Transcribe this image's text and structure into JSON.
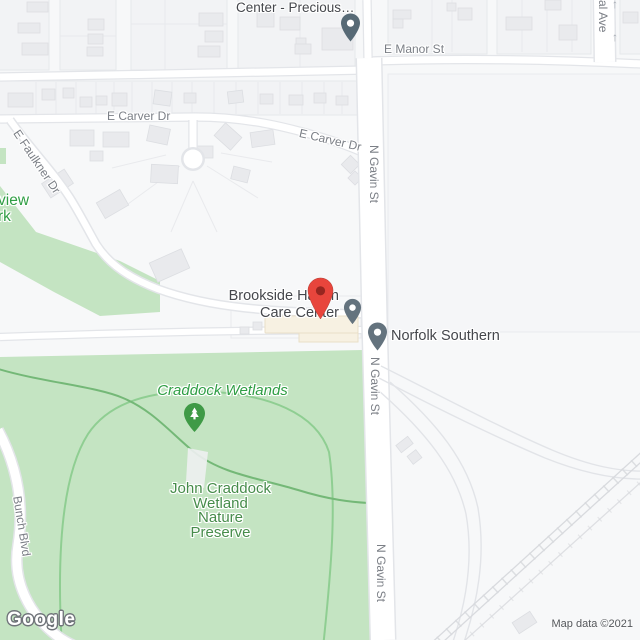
{
  "colors": {
    "land": "#f7f8f9",
    "block": "#f2f3f5",
    "block-line": "#e6e8eb",
    "building": "#e9eaed",
    "building-line": "#dcdee2",
    "road-fill": "#ffffff",
    "road-casing": "#e3e5e9",
    "park": "#c4e4c2",
    "trail": "#74b877",
    "preserve-line": "#8fce92",
    "street-label": "#7b7f86",
    "poi-label": "#45474c",
    "park-label": "#2f9e44",
    "preserve-label": "#468c4a",
    "pin-red": "#e8453c",
    "pin-red-dot": "#972620",
    "pin-gray": "#64737e",
    "pin-dark": "#576a76",
    "pin-green": "#3f9a46",
    "rail": "#d8dade",
    "ramp": "#e2e4e8",
    "poi-building": "#f7f1e2",
    "poi-building-line": "#eadfc8",
    "attr-text": "#53565a",
    "logo-outline": "#70747a",
    "oneway": "#a6abb3"
  },
  "streets": {
    "e_manor": "E Manor St",
    "e_carver_upper": "E Carver Dr",
    "e_carver_lower": "E Carver Dr",
    "e_faulkner": "E Faulkner Dr",
    "n_gavin_upper": "N Gavin St",
    "n_gavin_middle": "N Gavin St",
    "n_gavin_lower": "N Gavin St",
    "al_ave": "al Ave",
    "bunch_blvd": "Bunch Blvd"
  },
  "places": {
    "center_precious": "Center - Precious…",
    "brookside_line1": "Brookside Haven",
    "brookside_line2": "Care Center",
    "norfolk_southern": "Norfolk Southern",
    "craddock_wetlands": "Craddock Wetlands",
    "preserve_line1": "John Craddock",
    "preserve_line2": "Wetland",
    "preserve_line3": "Nature",
    "preserve_line4": "Preserve",
    "park_cut_line1": "view",
    "park_cut_line2": "rk"
  },
  "icons": {
    "oneway_arrow": "↑",
    "red_destination_pin": "red-map-pin",
    "poi_pin": "gray-map-pin",
    "nature_pin": "green-tree-pin"
  },
  "attribution": {
    "logo": "Google",
    "map_data": "Map data ©2021"
  }
}
